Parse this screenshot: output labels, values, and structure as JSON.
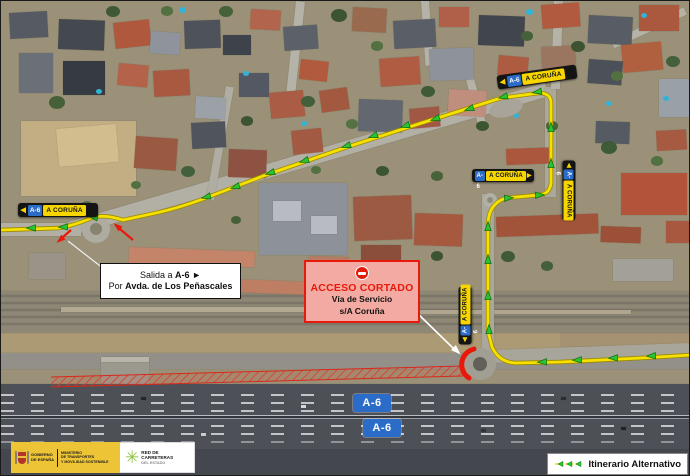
{
  "road_label": {
    "shield": "A-6",
    "destination": "A CORUÑA",
    "arrow_left": "◀",
    "arrow_right": "▶"
  },
  "highway_shield": {
    "text": "A-6"
  },
  "callout_salida": {
    "line1_pre": "Salida a",
    "line1_road": "A-6",
    "line1_arrow": "►",
    "line2_pre": "Por",
    "line2_road": "Avda. de Los Peñascales"
  },
  "callout_acceso": {
    "icon": "no-entry-icon",
    "title": "ACCESO CORTADO",
    "line1": "Vía de Servicio",
    "line2": "s/A Coruña"
  },
  "legend": {
    "label": "Itinerario Alternativo"
  },
  "footer": {
    "gobierno_line1": "GOBIERNO",
    "gobierno_line2": "DE ESPAÑA",
    "ministerio_line1": "MINISTERIO",
    "ministerio_line2": "DE TRANSPORTES",
    "ministerio_line3": "Y MOVILIDAD SOSTENIBLE",
    "red_line1": "RED DE",
    "red_line2": "CARRETERAS",
    "red_line3": "DEL ESTADO"
  },
  "colors": {
    "route_yellow": "#f5e000",
    "route_edge": "#9c8a00",
    "arrow_green": "#2bc32f",
    "arrow_green_edge": "#0b6b12",
    "closure_red": "#e8190a",
    "shield_blue": "#2a6cc8",
    "label_yellow": "#f7d600",
    "gov_yellow": "#eec437",
    "star_green": "#8dc63f"
  }
}
